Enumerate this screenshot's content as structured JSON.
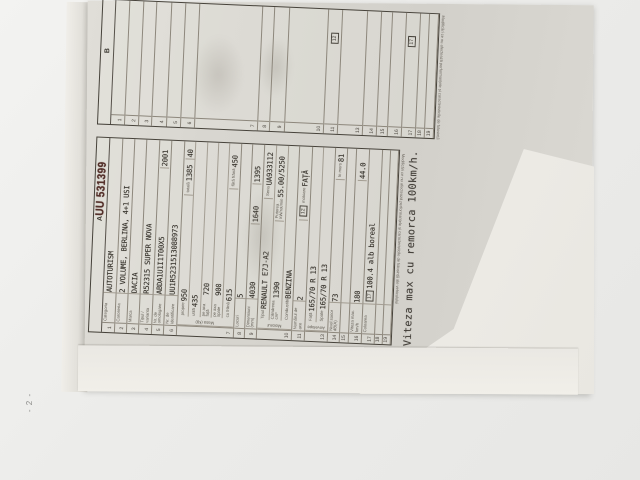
{
  "document": {
    "page_number": "- 2 -",
    "serial_number": "UU 531399",
    "section_a_letter": "A",
    "section_b_letter": "B",
    "stamp_note": "Viteza max cu remorca 100km/h.",
    "footer_caption": "Modificări ce nu afectează performanțele și caracteristicile de folosință ale vehiculului",
    "inline_box_12": "12",
    "inline_box_17": "17",
    "rows": [
      {
        "n": "1",
        "label": "Categoria",
        "h": 13,
        "cells": [
          {
            "t": "AUTOTURISM"
          }
        ]
      },
      {
        "n": "2",
        "label": "Caroseria",
        "h": 13,
        "cells": [
          {
            "t": "2 VOLUME, BERLINA, 4+1 USI"
          }
        ]
      },
      {
        "n": "3",
        "label": "Marca",
        "h": 12,
        "cells": [
          {
            "t": "DACIA"
          }
        ]
      },
      {
        "n": "4",
        "label": "Tipul / varianta",
        "h": 13,
        "cells": [
          {
            "t": "R52315 SUPER NOVA"
          }
        ]
      },
      {
        "n": "5",
        "label": "Nr. de omologare",
        "h": 13,
        "cells": [
          {
            "t": "ABDA1U1I1T00X5"
          },
          {
            "t": "2001",
            "w": 26
          }
        ]
      },
      {
        "n": "6",
        "label": "Nr. de identificare",
        "h": 13,
        "cells": [
          {
            "t": "UU1R5231513088973"
          }
        ]
      },
      {
        "n": "7",
        "label": "Masa (kg)",
        "h": 62,
        "group": [
          [
            {
              "l": "proprie",
              "t": "950"
            },
            {
              "l": "totală",
              "t": "1385",
              "w": 34
            },
            {
              "t": "40",
              "w": 16
            }
          ],
          [
            {
              "l": "utilă",
              "t": "435"
            }
          ],
          [
            {
              "l": "pe axa față",
              "t": "720"
            }
          ],
          [
            {
              "l": "pe axa spate",
              "t": "900"
            }
          ],
          [
            {
              "l": "cu frână",
              "t": "615"
            },
            {
              "l": "fără frână",
              "t": "450",
              "w": 44
            }
          ]
        ]
      },
      {
        "n": "8",
        "label": "Locuri",
        "h": 11,
        "cells": [
          {
            "t": "5"
          }
        ]
      },
      {
        "n": "9",
        "label": "Dimensiuni (mm)",
        "h": 13,
        "cells": [
          {
            "t": "4030"
          },
          {
            "t": "1640",
            "w": 38
          },
          {
            "t": "1395",
            "w": 38
          }
        ]
      },
      {
        "n": "10",
        "label": "Motorul",
        "h": 38,
        "group": [
          [
            {
              "l": "Tipul",
              "t": "RENAULT E7J-A2"
            },
            {
              "l": "Seria",
              "t": "UA933112",
              "w": 52
            }
          ],
          [
            {
              "l": "Cilindreea cm³",
              "t": "1390"
            },
            {
              "l": "Puterea kW/rot/min",
              "t": "55.00/5250",
              "w": 74
            }
          ],
          [
            {
              "l": "Combustibil",
              "t": "BENZINA"
            }
          ]
        ]
      },
      {
        "n": "11",
        "label": "Numărul de axe",
        "h": 13,
        "cells": [
          {
            "t": "2"
          },
          {
            "box": "12",
            "l": "motoare",
            "t": "FAȚĂ",
            "w": 72
          }
        ]
      },
      {
        "n": "13",
        "label": "Anvelope",
        "h": 24,
        "group": [
          [
            {
              "l": "Față",
              "t": "165/70 R 13"
            }
          ],
          [
            {
              "l": "Spate",
              "t": "165/70 R 13"
            }
          ]
        ]
      },
      {
        "n": "14",
        "label": "Nivel sonor dB(A)",
        "h": 13,
        "cells": [
          {
            "t": "73"
          },
          {
            "l": "în mers",
            "t": "81",
            "w": 30
          }
        ]
      },
      {
        "n": "15",
        "label": "",
        "h": 9,
        "cells": [
          {
            "t": ""
          }
        ]
      },
      {
        "n": "16",
        "label": "Viteza max. km/h",
        "h": 13,
        "cells": [
          {
            "t": "180"
          },
          {
            "t": "44.0",
            "w": 30
          }
        ]
      },
      {
        "n": "17",
        "label": "Culoarea",
        "h": 13,
        "cells": [
          {
            "box": "17",
            "t": "100.4 alb boreal"
          }
        ]
      },
      {
        "n": "18",
        "label": "",
        "h": 8,
        "cells": [
          {
            "t": ""
          }
        ]
      },
      {
        "n": "19",
        "label": "",
        "h": 8,
        "cells": [
          {
            "t": ""
          }
        ]
      }
    ]
  }
}
